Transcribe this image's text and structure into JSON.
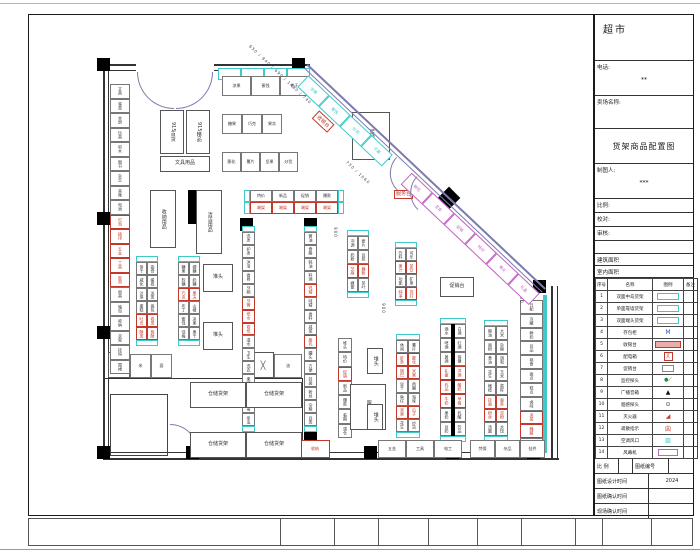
{
  "window": {
    "title": "超市"
  },
  "colors": {
    "cyan": "#3fc9c9",
    "red": "#c0392b",
    "magenta": "#c163c1",
    "wall_accent": "#7b7bb0",
    "ink": "#222222"
  },
  "title_block": {
    "store_type": "超市",
    "phone_label": "电话:",
    "phone_value": "**",
    "store_name_label": "卖场名称:",
    "drawing_title": "货架商品配置图",
    "drafter_label": "制图人:",
    "drafter_value": "***",
    "scale_label": "比例:",
    "check_label": "校对:",
    "review_label": "审核:",
    "building_area_label": "建筑面积",
    "indoor_area_label": "室内面积",
    "footer_row1_a": "比 例",
    "footer_row1_b": "图纸编号",
    "design_time_label": "图纸设计时间",
    "design_time_value": "2024",
    "confirm_time_label": "图纸确认时间",
    "site_confirm_label": "现场确认时间"
  },
  "legend": {
    "headers": [
      "序号",
      "名称",
      "图例",
      "备注"
    ],
    "rows": [
      {
        "num": "1",
        "name": "双面中岛货架",
        "sym": "cyan-rect"
      },
      {
        "num": "2",
        "name": "单面靠墙货架",
        "sym": "cyan-rect"
      },
      {
        "num": "3",
        "name": "双面端头货架",
        "sym": "cyan-rect"
      },
      {
        "num": "4",
        "name": "存包柜",
        "sym": "m-blue"
      },
      {
        "num": "5",
        "name": "收银台",
        "sym": "red-bar"
      },
      {
        "num": "6",
        "name": "配电箱",
        "sym": "red-box"
      },
      {
        "num": "7",
        "name": "促销台",
        "sym": "gray-rect"
      },
      {
        "num": "8",
        "name": "监控探头",
        "sym": "green-dot"
      },
      {
        "num": "9",
        "name": "广播音箱",
        "sym": "cone"
      },
      {
        "num": "10",
        "name": "烟感探头",
        "sym": "circle"
      },
      {
        "num": "11",
        "name": "灭火器",
        "sym": "red-wedge"
      },
      {
        "num": "12",
        "name": "疏散指示",
        "sym": "red-sign"
      },
      {
        "num": "13",
        "name": "空调风口",
        "sym": "cyan-hatch"
      },
      {
        "num": "14",
        "name": "风幕机",
        "sym": "magenta-rect"
      }
    ]
  },
  "footer_strip": {
    "cell_widths": [
      253,
      54,
      44,
      50,
      49,
      44,
      54,
      27,
      49,
      41
    ]
  },
  "plan": {
    "walls": [
      [
        103,
        64,
        33,
        2
      ],
      [
        214,
        64,
        96,
        2
      ],
      [
        103,
        70,
        33,
        1
      ],
      [
        214,
        70,
        96,
        1
      ],
      [
        103,
        64,
        2,
        396
      ],
      [
        108,
        70,
        1,
        384
      ],
      [
        551,
        286,
        2,
        174
      ],
      [
        557,
        286,
        1,
        174
      ],
      [
        103,
        458,
        456,
        2
      ],
      [
        110,
        452,
        436,
        1
      ],
      [
        103,
        378,
        200,
        1
      ],
      [
        302,
        378,
        1,
        81
      ]
    ],
    "cyan_bands": [
      [
        543,
        295,
        4,
        158
      ]
    ],
    "columns": [
      [
        97,
        58
      ],
      [
        292,
        58
      ],
      [
        97,
        212
      ],
      [
        97,
        326
      ],
      [
        97,
        446
      ],
      [
        186,
        446
      ],
      [
        240,
        218
      ],
      [
        304,
        218
      ],
      [
        240,
        432
      ],
      [
        304,
        432
      ],
      [
        364,
        446
      ],
      [
        446,
        446
      ],
      [
        527,
        446
      ],
      [
        533,
        280
      ]
    ],
    "diamond": {
      "x": 441,
      "y": 190,
      "s": 16
    },
    "stub": [
      188,
      190,
      9,
      34
    ],
    "office": {
      "x": 110,
      "y": 394,
      "w": 58,
      "h": 62
    },
    "xboxes": [
      [
        108,
        352,
        22,
        26
      ],
      [
        252,
        352,
        22,
        26
      ]
    ],
    "runs": [
      {
        "x": 110,
        "y": 84,
        "w": 20,
        "h": 290,
        "n": 20,
        "cols": 1,
        "caps": false,
        "red": [
          9,
          10,
          11,
          12,
          13
        ],
        "labels": [
          "文具",
          "笔类",
          "本册",
          "玩具",
          "积木",
          "图书",
          "杂志",
          "音像",
          "电池",
          "灯泡",
          "插排",
          "五金",
          "工具",
          "胶带",
          "雨具",
          "箱包",
          "收纳",
          "衣架",
          "挂钩",
          "围裙"
        ]
      },
      {
        "x": 136,
        "y": 256,
        "w": 22,
        "h": 90,
        "n": 6,
        "cols": 2,
        "caps": true,
        "red": [
          4,
          5
        ],
        "labels": [
          "饼干",
          "曲奇",
          "威化",
          "蛋卷",
          "沙琪",
          "派类",
          "蛋糕",
          "面包",
          "吐司",
          "卷类",
          "酥类",
          "桃酥"
        ]
      },
      {
        "x": 178,
        "y": 256,
        "w": 22,
        "h": 90,
        "n": 6,
        "cols": 2,
        "caps": true,
        "red": [
          2,
          7
        ],
        "labels": [
          "糖果",
          "硬糖",
          "软糖",
          "奶糖",
          "巧克",
          "果冻",
          "布丁",
          "山楂",
          "蜜饯",
          "凉果",
          "话梅",
          "果干"
        ]
      },
      {
        "x": 242,
        "y": 226,
        "w": 13,
        "h": 206,
        "n": 15,
        "cols": 1,
        "caps": true,
        "red": [
          5,
          6,
          7
        ],
        "labels": [
          "洗发",
          "护发",
          "沐浴",
          "香皂",
          "牙刷",
          "牙膏",
          "纸巾",
          "卷纸",
          "湿巾",
          "卫生",
          "洗衣",
          "柔顺",
          "清洁",
          "消毒",
          "杀虫"
        ]
      },
      {
        "x": 304,
        "y": 226,
        "w": 13,
        "h": 206,
        "n": 15,
        "cols": 1,
        "caps": true,
        "red": [
          4,
          8
        ],
        "labels": [
          "酱油",
          "食醋",
          "蚝油",
          "料酒",
          "鸡精",
          "味精",
          "香料",
          "咸菜",
          "腐乳",
          "罐头",
          "方便",
          "挂面",
          "粉丝",
          "杂粮",
          "豆类"
        ]
      },
      {
        "x": 347,
        "y": 230,
        "w": 22,
        "h": 68,
        "n": 4,
        "cols": 2,
        "caps": true,
        "red": [
          2
        ],
        "labels": [
          "冲调",
          "麦片",
          "奶粉",
          "豆浆",
          "芝麻",
          "藕粉",
          "蜂蜜",
          "茶叶"
        ]
      },
      {
        "x": 395,
        "y": 242,
        "w": 22,
        "h": 64,
        "n": 4,
        "cols": 2,
        "caps": true,
        "red": [
          1,
          3
        ],
        "labels": [
          "饮料",
          "可乐",
          "果汁",
          "茶饮",
          "功能",
          "矿泉",
          "纯净",
          "苏打"
        ]
      },
      {
        "x": 338,
        "y": 338,
        "w": 14,
        "h": 100,
        "n": 7,
        "cols": 1,
        "caps": false,
        "red": [
          2
        ],
        "labels": [
          "堆头",
          "特价",
          "促销",
          "新品",
          "爆款",
          "临期",
          "清仓"
        ]
      },
      {
        "x": 396,
        "y": 334,
        "w": 24,
        "h": 104,
        "n": 7,
        "cols": 2,
        "caps": true,
        "red": [
          1,
          2,
          5
        ],
        "labels": [
          "休闲",
          "薯片",
          "虾条",
          "膨化",
          "锅巴",
          "米果",
          "豆干",
          "肉脯",
          "鱼仔",
          "海味",
          "坚果",
          "瓜子",
          "花生",
          "炒货"
        ]
      },
      {
        "x": 440,
        "y": 318,
        "w": 26,
        "h": 124,
        "n": 8,
        "cols": 2,
        "caps": true,
        "red": [
          3,
          4,
          5
        ],
        "divider": true,
        "labels": [
          "酒水",
          "白酒",
          "啤酒",
          "红酒",
          "黄酒",
          "保健",
          "礼盒",
          "洋酒",
          "乳品",
          "酸奶",
          "牛奶",
          "早餐",
          "果奶",
          "乳酸",
          "豆奶",
          "饮品"
        ]
      },
      {
        "x": 484,
        "y": 320,
        "w": 24,
        "h": 122,
        "n": 8,
        "cols": 2,
        "caps": true,
        "red": [
          5,
          6
        ],
        "labels": [
          "粮油",
          "大米",
          "面粉",
          "杂粮",
          "食油",
          "调和",
          "花生",
          "玉米",
          "橄榄",
          "菜籽",
          "挂面",
          "面条",
          "粉丝",
          "淀粉",
          "汤圆",
          "水饺"
        ]
      },
      {
        "x": 520,
        "y": 300,
        "w": 23,
        "h": 152,
        "n": 11,
        "cols": 1,
        "caps": false,
        "red": [
          8,
          9
        ],
        "labels": [
          "日配",
          "冷藏",
          "鲜奶",
          "豆品",
          "熟食",
          "面点",
          "糕点",
          "卤味",
          "凉菜",
          "腌腊",
          "冻品"
        ]
      }
    ],
    "rows": [
      {
        "x": 218,
        "y": 68,
        "h": 12,
        "cw": 23,
        "labels": [
          "",
          "",
          "",
          ""
        ],
        "cyan": true,
        "red": []
      },
      {
        "x": 222,
        "y": 76,
        "h": 20,
        "cw": 29,
        "labels": [
          "凉果",
          "蜜饯",
          "饼干"
        ],
        "red": []
      },
      {
        "x": 222,
        "y": 114,
        "h": 20,
        "cw": 20,
        "labels": [
          "糖果",
          "巧克",
          "果冻"
        ],
        "red": []
      },
      {
        "x": 222,
        "y": 152,
        "h": 20,
        "cw": 19,
        "labels": [
          "膨化",
          "薯片",
          "坚果",
          "炒货"
        ],
        "red": []
      },
      {
        "x": 244,
        "y": 190,
        "h": 12,
        "cw": 22,
        "labels": [
          "特价",
          "新品",
          "促销",
          "爆款"
        ],
        "caps": true,
        "red": []
      },
      {
        "x": 244,
        "y": 202,
        "h": 12,
        "cw": 22,
        "labels": [
          "端架",
          "端架",
          "端架",
          "端架"
        ],
        "caps": true,
        "red": [
          0,
          1,
          2,
          3
        ]
      },
      {
        "x": 240,
        "y": 440,
        "h": 18,
        "cw": 30,
        "labels": [
          "清洁",
          "拖把",
          "收纳"
        ],
        "red": [
          1,
          2
        ]
      },
      {
        "x": 378,
        "y": 440,
        "h": 18,
        "cw": 28,
        "labels": [
          "五金",
          "工具",
          "电工"
        ],
        "red": []
      },
      {
        "x": 470,
        "y": 440,
        "h": 18,
        "cw": 25,
        "labels": [
          "劳保",
          "杂品",
          "挂件"
        ],
        "red": []
      },
      {
        "x": 130,
        "y": 354,
        "h": 24,
        "cw": 21,
        "labels": [
          "米",
          "面"
        ],
        "red": []
      },
      {
        "x": 274,
        "y": 354,
        "h": 24,
        "cw": 28,
        "labels": [
          "油"
        ],
        "red": []
      }
    ],
    "blocks": [
      [
        160,
        110,
        24,
        44,
        "915百货"
      ],
      [
        186,
        110,
        24,
        44,
        "915精品"
      ],
      [
        160,
        156,
        50,
        16,
        "文具用品"
      ],
      [
        150,
        190,
        26,
        58,
        "收纳用品"
      ],
      [
        196,
        190,
        26,
        64,
        "清洁用品"
      ],
      [
        203,
        264,
        30,
        28,
        "堆头"
      ],
      [
        203,
        322,
        30,
        28,
        "堆头"
      ],
      [
        352,
        112,
        38,
        48,
        "促销台"
      ],
      [
        440,
        277,
        34,
        20,
        "促销台"
      ],
      [
        350,
        384,
        36,
        46,
        "服装台"
      ],
      [
        367,
        348,
        16,
        26,
        "堆头"
      ],
      [
        367,
        404,
        16,
        26,
        "堆头"
      ],
      [
        190,
        382,
        56,
        26,
        "仓储货架"
      ],
      [
        246,
        382,
        56,
        26,
        "仓储货架"
      ],
      [
        190,
        432,
        56,
        26,
        "仓储货架"
      ],
      [
        246,
        432,
        56,
        26,
        "仓储货架"
      ]
    ],
    "texts": [
      {
        "x": 394,
        "y": 190,
        "t": "服务台",
        "kind": "red",
        "rot": 0
      },
      {
        "x": 330,
        "y": 230,
        "t": "900",
        "kind": "dim",
        "rot": 90
      },
      {
        "x": 378,
        "y": 306,
        "t": "900",
        "kind": "dim",
        "rot": 90
      },
      {
        "x": 516,
        "y": 296,
        "t": "900",
        "kind": "dim",
        "rot": 90
      }
    ],
    "diag": {
      "x": 308,
      "y": 64,
      "angle": 43.3,
      "len": 327,
      "strips": [
        {
          "t": 8,
          "len": 116,
          "n": 4,
          "color": "cyan",
          "labels": [
            "凉果",
            "蜜饯",
            "炒货",
            "干果"
          ]
        },
        {
          "t": 150,
          "len": 176,
          "n": 6,
          "color": "magenta",
          "labels": [
            "鲜花",
            "花车",
            "促销",
            "特价",
            "堆头",
            "礼盒"
          ]
        }
      ],
      "dims": [
        {
          "t": -55,
          "off": 24,
          "w": 200,
          "text": "650 / 940 / 690 / 1480 / 740"
        },
        {
          "t": 95,
          "off": 42,
          "w": 120,
          "text": "730 / 1060"
        }
      ],
      "redbox": {
        "t": 40,
        "label": "收银台"
      },
      "arcs": [
        128,
        156
      ]
    }
  }
}
